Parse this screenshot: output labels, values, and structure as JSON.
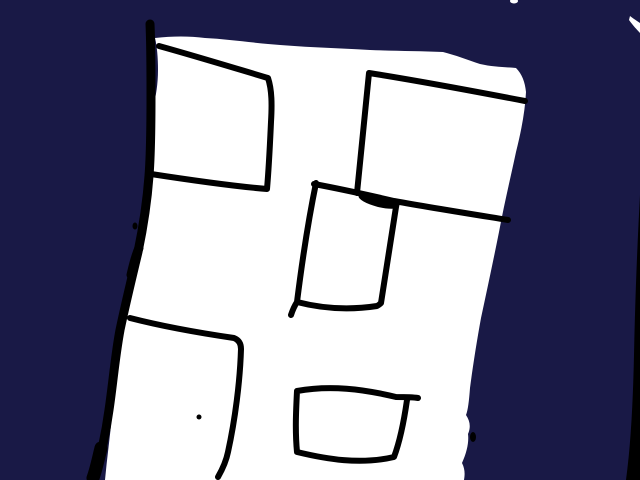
{
  "canvas": {
    "width": 640,
    "height": 480,
    "background_color": "#191946",
    "paper_color": "#ffffff",
    "ink_color": "#000000",
    "description": "Freehand marker drawing: a white hand-drawn sheet on a dark navy background, bordered on the left by a thick black stroke, containing five hand-drawn black rectangle outlines and a small ink dot",
    "shapes": [
      {
        "name": "paper-sheet",
        "type": "path",
        "fill": "#ffffff",
        "d": "M 155,38 C 172,36 190,36 205,38 C 225,39 247,42 268,44 C 300,47 335,48 370,50 C 395,51 420,51 443,52 C 455,55 468,60 480,64 C 493,67 505,67 516,68 C 522,74 525,82 526,92 C 525,112 521,132 516,152 C 510,180 504,205 499,232 C 493,262 487,290 481,318 C 477,340 473,365 470,388 C 469,401 468,410 466,415 C 470,421 471,427 468,434 C 469,442 467,452 462,463 C 465,469 465,474 464,480 L 105,480 C 107,458 110,437 112,415 C 115,390 117,368 120,348 C 123,327 128,307 133,287 C 139,265 143,245 146,224 C 148,205 150,186 151,166 C 152,146 152,126 153,108 C 156,96 158,84 158,70 C 158,58 157,46 155,38 Z"
      },
      {
        "name": "sheet-left-border-stroke",
        "type": "path",
        "stroke": "#000000",
        "stroke_width": 9,
        "d": "M 150,24 C 151,45 151,70 151,95 C 151,122 151,150 149,176 C 147,203 143,228 138,252 C 131,281 125,306 120,330 C 115,357 113,383 109,410 C 106,432 101,456 94,478"
      },
      {
        "name": "border-bulge-stroke",
        "type": "path",
        "stroke": "#000000",
        "stroke_width": 9,
        "d": "M 139,248 C 135,257 133,266 131,275"
      },
      {
        "name": "border-ink-speck",
        "type": "ellipse",
        "cx": 135,
        "cy": 226,
        "rx": 2.5,
        "ry": 3.5,
        "fill": "#000000"
      },
      {
        "name": "border-foot-stroke",
        "type": "path",
        "stroke": "#000000",
        "stroke_width": 13,
        "d": "M 101,448 C 98,460 96,470 93,478"
      },
      {
        "name": "rect-top-left",
        "type": "path",
        "stroke": "#000000",
        "stroke_width": 6,
        "d": "M 159,46 C 195,56 231,67 268,78 C 272,90 272,105 271,122 C 270,144 269,166 267,189 C 230,186 190,180 151,174"
      },
      {
        "name": "rect-top-right",
        "type": "path",
        "stroke": "#000000",
        "stroke_width": 6,
        "d": "M 357,193 C 361,153 365,113 369,73 C 420,81 473,91 525,101"
      },
      {
        "name": "crossbar-stroke",
        "type": "path",
        "stroke": "#000000",
        "stroke_width": 6,
        "d": "M 314,184 C 341,189 368,195 394,201 C 433,208 471,214 508,220"
      },
      {
        "name": "junction-ink-blob",
        "type": "ellipse",
        "cx": 379,
        "cy": 201,
        "rx": 21,
        "ry": 6,
        "rotate": 14,
        "fill": "#000000"
      },
      {
        "name": "rect-middle",
        "type": "path",
        "stroke": "#000000",
        "stroke_width": 6,
        "d": "M 316,183 C 308,222 302,262 297,302 M 291,315 C 293,309 295,305 297,302 C 324,309 351,310 377,306 C 379,305 380,304 381,303 C 386,271 391,239 396,207"
      },
      {
        "name": "rect-bottom-left",
        "type": "path",
        "stroke": "#000000",
        "stroke_width": 6,
        "d": "M 130,318 C 165,327 200,333 234,338 C 239,340 241,344 241,349 C 240,382 235,420 228,452 C 226,462 222,470 218,477"
      },
      {
        "name": "rect-bottom-small",
        "type": "path",
        "stroke": "#000000",
        "stroke_width": 6,
        "d": "M 297,391 C 330,385 363,389 396,397 C 404,397 412,397 418,398 M 407,400 C 404,421 400,441 394,457 C 360,465 326,459 297,452 C 295,431 296,411 297,391"
      },
      {
        "name": "ink-dot",
        "type": "ellipse",
        "cx": 199,
        "cy": 417,
        "rx": 2.5,
        "ry": 2.5,
        "fill": "#000000"
      },
      {
        "name": "edge-ink-fleck",
        "type": "ellipse",
        "cx": 473,
        "cy": 437,
        "rx": 3,
        "ry": 5,
        "fill": "#000000"
      },
      {
        "name": "right-edge-sliver",
        "type": "path",
        "fill": "#000000",
        "d": "M 640,195 C 637,250 635,305 634,355 C 633,400 631,443 626,480 L 640,480 Z"
      },
      {
        "name": "corner-white-wedge",
        "type": "path",
        "fill": "#ffffff",
        "d": "M 630,16 C 634,19 637,21 640,23 L 640,33 C 636,29 632,24 629,20 Z"
      },
      {
        "name": "top-white-speck",
        "type": "ellipse",
        "cx": 514,
        "cy": 1,
        "rx": 4,
        "ry": 2.5,
        "fill": "#ffffff"
      }
    ]
  }
}
